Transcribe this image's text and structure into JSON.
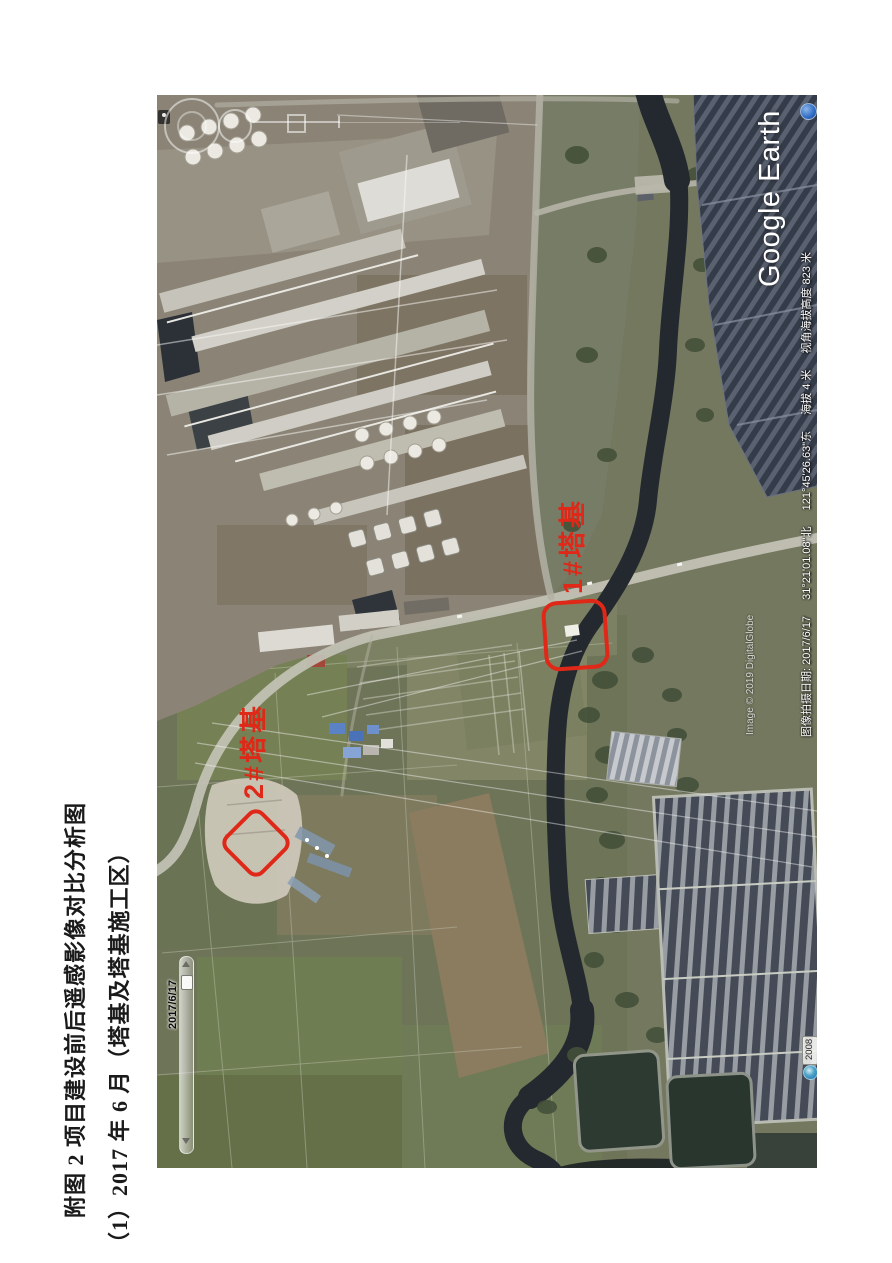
{
  "document": {
    "caption_line1": "附图 2 项目建设前后遥感影像对比分析图",
    "caption_line2": "（1）2017 年 6 月（塔基及塔基施工区）"
  },
  "google_earth": {
    "logo_text": "Google Earth",
    "attribution": "Image © 2019 DigitalGlobe",
    "status_bar": {
      "capture_date_label": "图像拍摄日期: 2017/6/17",
      "latitude": "31°21'01.08\"北",
      "longitude": "121°45'26.63\"东",
      "elevation": "海拔 4 米",
      "eye_altitude": "视角海拔高度 823 米"
    },
    "time_slider": {
      "current_date": "2017/6/17",
      "range_start_year": "2008"
    },
    "annotations": [
      {
        "id": "tower-1",
        "label": "1#塔基"
      },
      {
        "id": "tower-2",
        "label": "2#塔基"
      }
    ],
    "colors": {
      "annotation_red": "#e02818",
      "logo_white": "#ffffff"
    }
  }
}
